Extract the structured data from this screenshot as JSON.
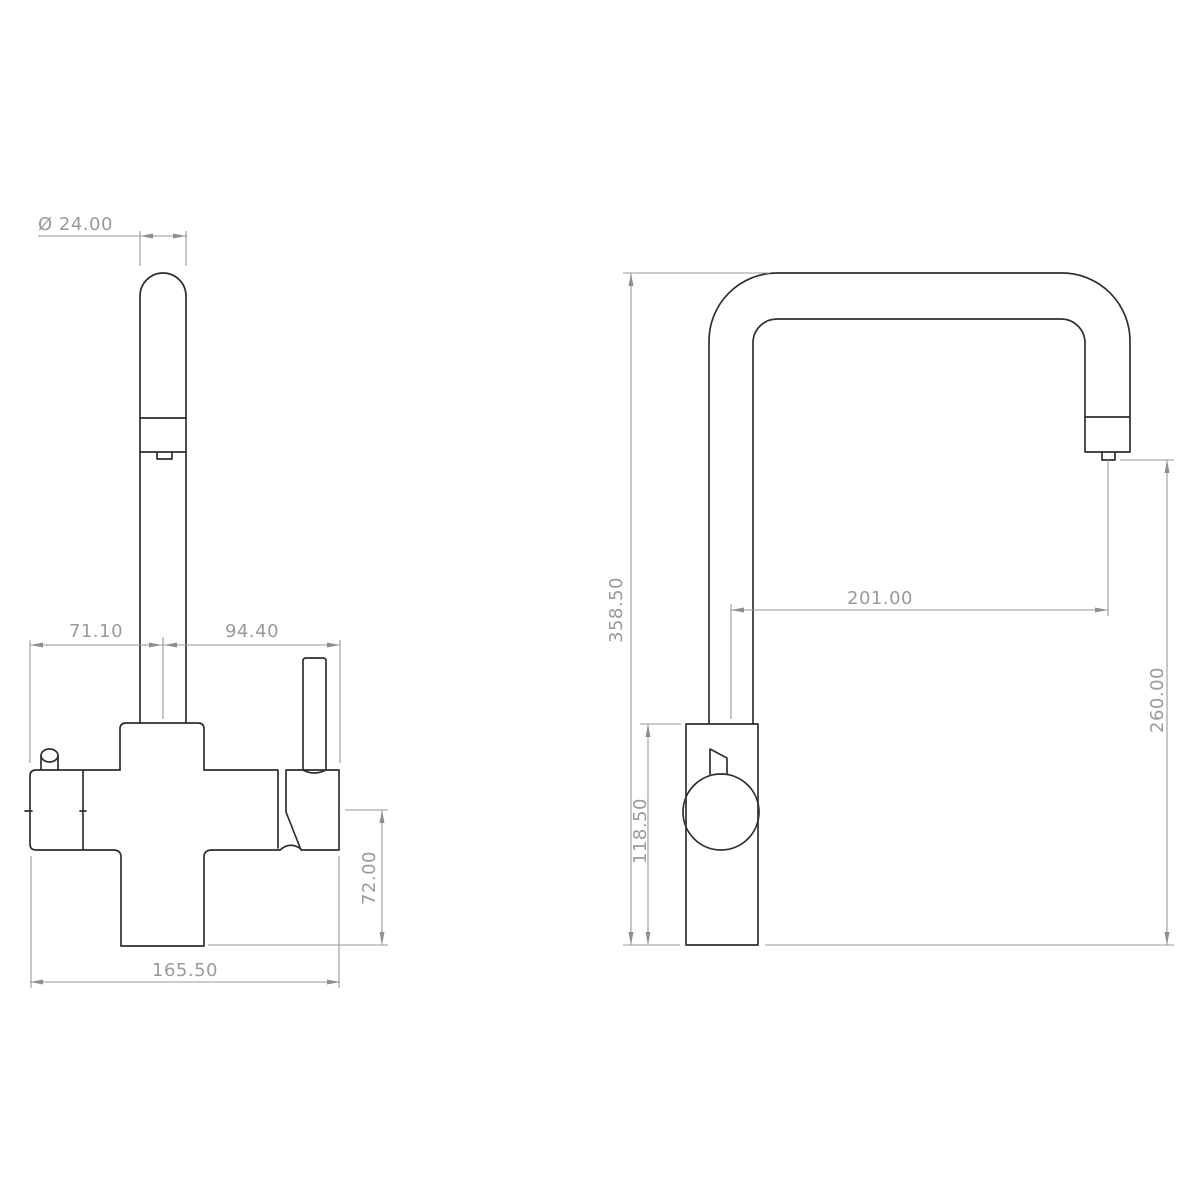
{
  "drawing": {
    "background": "#ffffff",
    "part_line_color": "#2f2f2f",
    "dim_line_color": "#999999",
    "front_view": {
      "dims": {
        "head_diameter": "Ø 24.00",
        "spout_left_offset": "71.10",
        "handle_right_offset": "94.40",
        "outlet_drop": "72.00",
        "overall_width": "165.50"
      }
    },
    "side_view": {
      "dims": {
        "overall_height": "358.50",
        "body_height": "118.50",
        "spout_reach": "201.00",
        "outlet_height": "260.00"
      }
    }
  }
}
